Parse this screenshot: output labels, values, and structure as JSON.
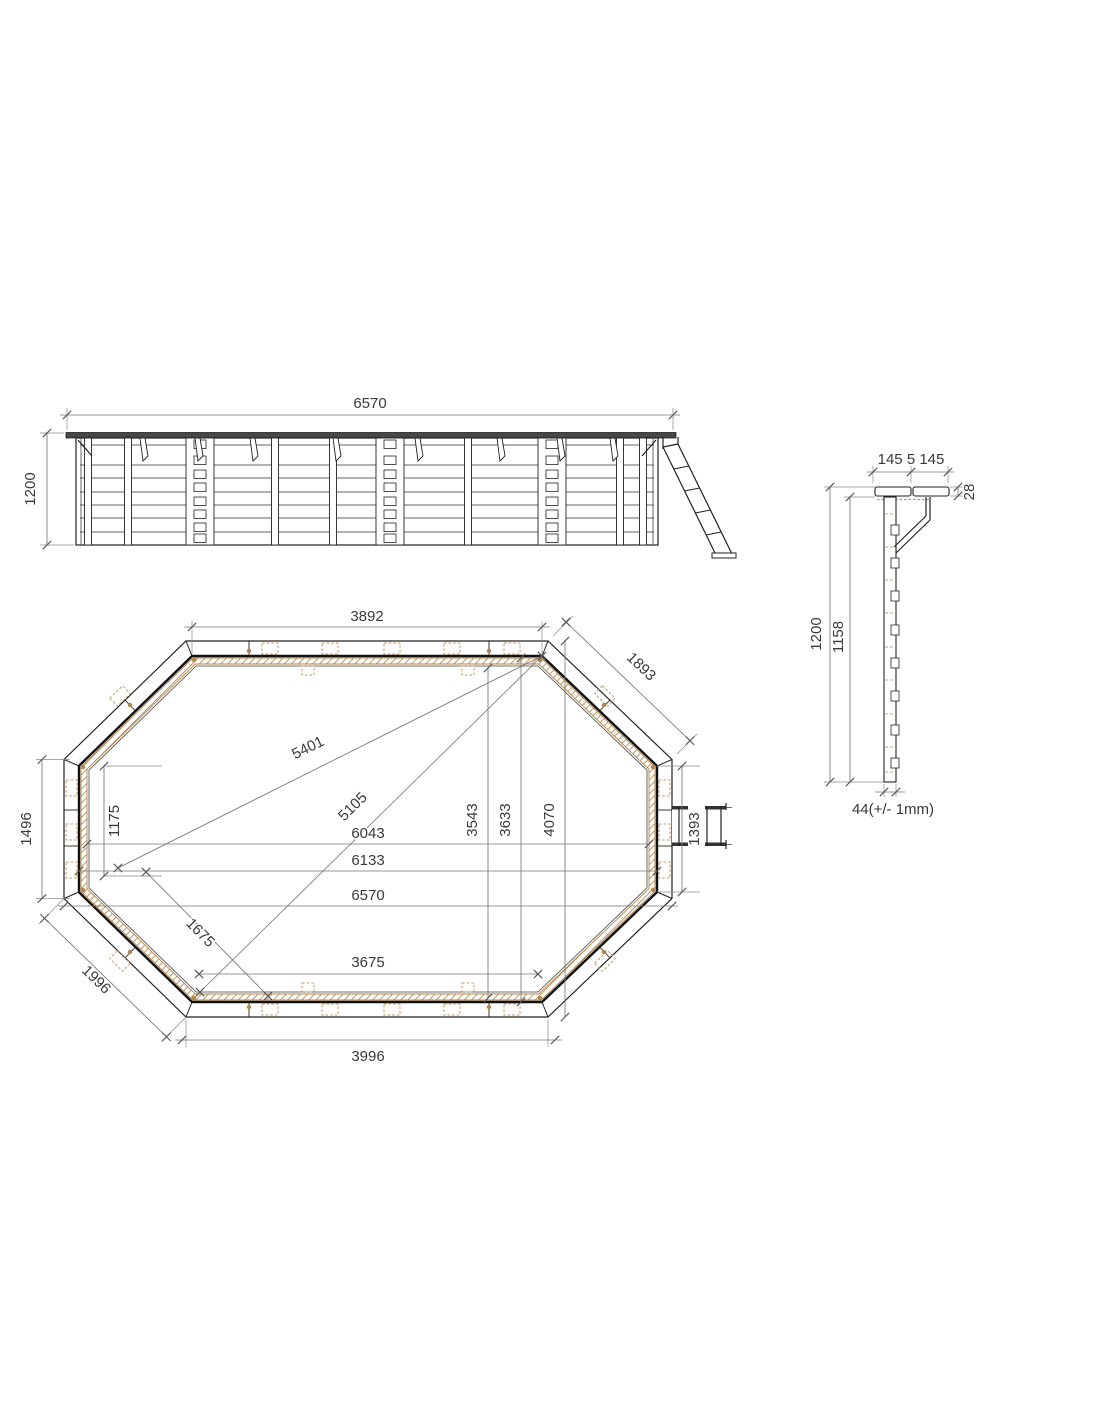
{
  "side_view": {
    "length": "6570",
    "height": "1200"
  },
  "plan_view": {
    "inner_top_width": "3892",
    "top_right_edge": "1893",
    "diagonal_max": "5401",
    "diagonal_inner": "5105",
    "liner_width": "6043",
    "inner_width": "6133",
    "outer_width": "6570",
    "inner_bottom_width": "3675",
    "outer_bottom_width": "3996",
    "left_side_height": "1496",
    "left_upper_offset": "1175",
    "bottom_left_edge_inner": "1675",
    "bottom_left_edge_outer": "1996",
    "liner_height": "3543",
    "inner_height": "3633",
    "outer_height": "4070",
    "right_side_height": "1393"
  },
  "section_view": {
    "coping_boards": "145 5 145",
    "coping_thickness": "28",
    "wall_height": "1200",
    "inner_height": "1158",
    "plank_thickness": "44(+/- 1mm)"
  },
  "colors": {
    "line": "#222222",
    "dim": "#777777",
    "wood": "#b5854e",
    "wood_light": "#c59a62",
    "coping_fill": "#474747",
    "liner_hint": "#8b9dc7"
  }
}
